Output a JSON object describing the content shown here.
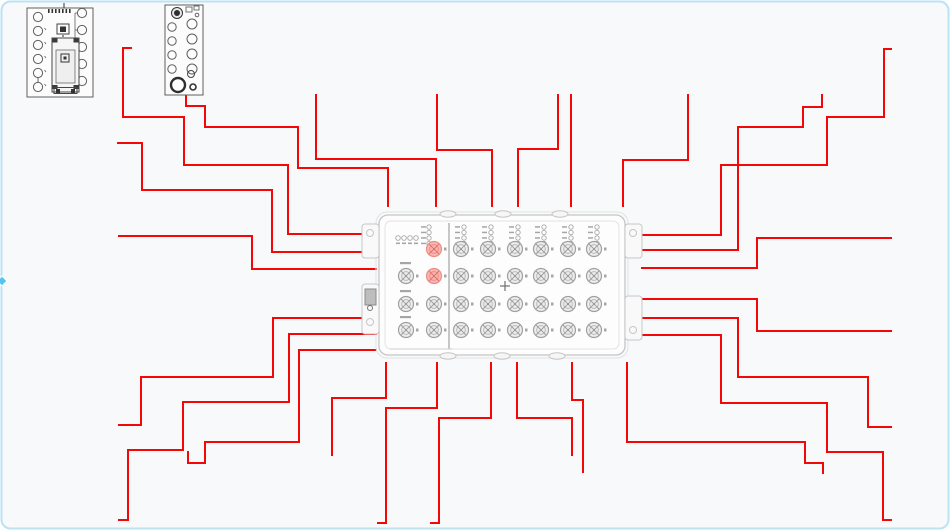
{
  "canvas": {
    "width": 950,
    "height": 530,
    "background": "#f8f9fa",
    "frame_color": "#bce2f4",
    "frame_radius": 9,
    "handle": {
      "x": 2,
      "y": 281,
      "size": 7
    }
  },
  "colors": {
    "wire": "#f50707",
    "handle": "#52c5f2",
    "device_outline": "#c6c6c6",
    "device_outline_light": "#e2e2e2",
    "device_fill": "#fdfdfd",
    "divider": "#b5b5b5",
    "port_stroke": "#a0a0a0",
    "port_fill": "#ededed",
    "port_inner": "#b8b8b8",
    "port_cross": "#9a9a9a",
    "pink_fill": "#f7b6b1",
    "pink_stroke": "#ef8d85",
    "pink_cross": "#e06e65",
    "led_stroke": "#a8a8a8",
    "speck": "#a6a6a6",
    "center_cross": "#6f6f6f",
    "module_stroke": "#5f5f5f",
    "module_dark": "#333333",
    "ear_dark": "#8a8a8a"
  },
  "wires": [
    {
      "id": "upper-left-1",
      "points": [
        [
          131,
          48
        ],
        [
          123,
          48
        ],
        [
          123,
          117
        ],
        [
          184,
          117
        ],
        [
          184,
          165
        ],
        [
          288,
          165
        ],
        [
          288,
          234
        ],
        [
          376,
          234
        ]
      ]
    },
    {
      "id": "upper-left-2",
      "points": [
        [
          118,
          143
        ],
        [
          142,
          143
        ],
        [
          142,
          190
        ],
        [
          272,
          190
        ],
        [
          272,
          252
        ],
        [
          376,
          252
        ]
      ]
    },
    {
      "id": "upper-left-3",
      "points": [
        [
          119,
          236
        ],
        [
          252,
          236
        ],
        [
          252,
          269
        ],
        [
          376,
          269
        ]
      ]
    },
    {
      "id": "lower-left-1",
      "points": [
        [
          376,
          318
        ],
        [
          273,
          318
        ],
        [
          273,
          377
        ],
        [
          141,
          377
        ],
        [
          141,
          425
        ],
        [
          119,
          425
        ]
      ]
    },
    {
      "id": "lower-left-2",
      "points": [
        [
          376,
          334
        ],
        [
          289,
          334
        ],
        [
          289,
          402
        ],
        [
          183,
          402
        ],
        [
          183,
          450
        ],
        [
          128,
          450
        ],
        [
          128,
          520
        ],
        [
          119,
          520
        ]
      ]
    },
    {
      "id": "lower-left-3",
      "points": [
        [
          376,
          350
        ],
        [
          299,
          350
        ],
        [
          299,
          442
        ],
        [
          205,
          442
        ],
        [
          205,
          463
        ],
        [
          188,
          463
        ],
        [
          188,
          452
        ]
      ]
    },
    {
      "id": "module2-feed",
      "points": [
        [
          186,
          93
        ],
        [
          186,
          106
        ],
        [
          205,
          106
        ],
        [
          205,
          127
        ],
        [
          298,
          127
        ],
        [
          298,
          168
        ],
        [
          388,
          168
        ],
        [
          388,
          206
        ]
      ]
    },
    {
      "id": "top-2",
      "points": [
        [
          316,
          95
        ],
        [
          316,
          159
        ],
        [
          436,
          159
        ],
        [
          436,
          206
        ]
      ]
    },
    {
      "id": "top-3",
      "points": [
        [
          437,
          95
        ],
        [
          437,
          150
        ],
        [
          492,
          150
        ],
        [
          492,
          206
        ]
      ]
    },
    {
      "id": "top-4",
      "points": [
        [
          558,
          95
        ],
        [
          558,
          149
        ],
        [
          518,
          149
        ],
        [
          518,
          206
        ]
      ]
    },
    {
      "id": "top-5",
      "points": [
        [
          571,
          95
        ],
        [
          571,
          206
        ]
      ]
    },
    {
      "id": "top-6",
      "points": [
        [
          688,
          95
        ],
        [
          688,
          160
        ],
        [
          623,
          160
        ],
        [
          623,
          206
        ]
      ]
    },
    {
      "id": "bottom-1",
      "points": [
        [
          386,
          363
        ],
        [
          386,
          398
        ],
        [
          332,
          398
        ],
        [
          332,
          455
        ]
      ]
    },
    {
      "id": "bottom-2",
      "points": [
        [
          437,
          363
        ],
        [
          437,
          408
        ],
        [
          386,
          408
        ],
        [
          386,
          523
        ],
        [
          378,
          523
        ]
      ]
    },
    {
      "id": "bottom-3",
      "points": [
        [
          491,
          363
        ],
        [
          491,
          418
        ],
        [
          439,
          418
        ],
        [
          439,
          523
        ],
        [
          431,
          523
        ]
      ]
    },
    {
      "id": "bottom-4",
      "points": [
        [
          517,
          363
        ],
        [
          517,
          418
        ],
        [
          572,
          418
        ],
        [
          572,
          455
        ]
      ]
    },
    {
      "id": "bottom-5",
      "points": [
        [
          572,
          363
        ],
        [
          572,
          400
        ],
        [
          583,
          400
        ],
        [
          583,
          472
        ]
      ]
    },
    {
      "id": "bottom-6",
      "points": [
        [
          627,
          363
        ],
        [
          627,
          442
        ],
        [
          805,
          442
        ],
        [
          805,
          463
        ],
        [
          823,
          463
        ],
        [
          823,
          473
        ]
      ]
    },
    {
      "id": "right-1",
      "points": [
        [
          642,
          235
        ],
        [
          721,
          235
        ],
        [
          721,
          165
        ],
        [
          827,
          165
        ],
        [
          827,
          117
        ],
        [
          884,
          117
        ],
        [
          884,
          49
        ],
        [
          891,
          49
        ]
      ]
    },
    {
      "id": "right-2",
      "points": [
        [
          642,
          250
        ],
        [
          738,
          250
        ],
        [
          738,
          127
        ],
        [
          803,
          127
        ],
        [
          803,
          107
        ],
        [
          822,
          107
        ],
        [
          822,
          95
        ]
      ]
    },
    {
      "id": "right-3",
      "points": [
        [
          642,
          268
        ],
        [
          757,
          268
        ],
        [
          757,
          238
        ],
        [
          891,
          238
        ]
      ]
    },
    {
      "id": "right-4",
      "points": [
        [
          642,
          299
        ],
        [
          757,
          299
        ],
        [
          757,
          331
        ],
        [
          891,
          331
        ]
      ]
    },
    {
      "id": "right-5",
      "points": [
        [
          642,
          318
        ],
        [
          738,
          318
        ],
        [
          738,
          377
        ],
        [
          868,
          377
        ],
        [
          868,
          427
        ],
        [
          891,
          427
        ]
      ]
    },
    {
      "id": "right-6",
      "points": [
        [
          642,
          335
        ],
        [
          721,
          335
        ],
        [
          721,
          403
        ],
        [
          827,
          403
        ],
        [
          827,
          452
        ],
        [
          883,
          452
        ],
        [
          883,
          520
        ],
        [
          891,
          520
        ]
      ]
    }
  ],
  "device": {
    "outer": {
      "x": 376,
      "y": 212,
      "w": 252,
      "h": 146,
      "r": 11
    },
    "body": {
      "x": 379,
      "y": 215,
      "w": 246,
      "h": 140,
      "r": 9
    },
    "inner": {
      "x": 385,
      "y": 221,
      "w": 234,
      "h": 128,
      "r": 6
    },
    "divider_x": 449,
    "divider_y1": 223,
    "divider_y2": 349,
    "top_tabs": [
      448,
      503,
      560
    ],
    "bottom_tabs": [
      448,
      502,
      557
    ],
    "left_ears": [
      {
        "x": 362,
        "y": 224,
        "w": 17,
        "h": 34
      },
      {
        "x": 362,
        "y": 284,
        "w": 17,
        "h": 50
      }
    ],
    "right_ears": [
      {
        "x": 625,
        "y": 224,
        "w": 17,
        "h": 34
      },
      {
        "x": 625,
        "y": 296,
        "w": 17,
        "h": 44
      }
    ],
    "ear_screws": [
      [
        370,
        233
      ],
      [
        370,
        322
      ],
      [
        633,
        233
      ],
      [
        633,
        330
      ]
    ],
    "dark_block": {
      "x": 365,
      "y": 289,
      "w": 11,
      "h": 16
    },
    "dark_block_screw": [
      370,
      308
    ],
    "port_r": 7.5,
    "grid_cols": [
      461,
      488,
      515,
      541,
      568,
      594
    ],
    "grid_rows": [
      249,
      276,
      304,
      330
    ],
    "col2_x": 434,
    "col2_rows": [
      249,
      276,
      304,
      330
    ],
    "col2_pink_rows": [
      0,
      1
    ],
    "left_col_x": 406,
    "left_col_rows": [
      276,
      304,
      330
    ],
    "led_stack_ys": [
      227,
      232.5,
      238,
      243.5
    ],
    "top_led_row": {
      "y": 238,
      "xs": [
        398,
        404,
        410,
        416
      ]
    },
    "top_led_stack_x": 429,
    "center_cross": {
      "x": 505,
      "y": 286,
      "arm": 5
    },
    "bottom_strip": {
      "x1": 390,
      "y": 349,
      "x2": 453
    }
  },
  "module1": {
    "frame": {
      "x": 27,
      "y": 8,
      "w": 66,
      "h": 89
    },
    "left_circles": {
      "cx": 38,
      "r": 4.6,
      "cys": [
        17,
        31,
        45,
        59,
        73,
        87
      ]
    },
    "right_circles": {
      "cx": 82,
      "r": 4.6,
      "cys": [
        13,
        30,
        47,
        64,
        81
      ]
    },
    "link_segment": [
      38,
      77.6,
      38,
      82.4
    ],
    "bracket": {
      "x": 75,
      "y1": 13,
      "y2": 47,
      "stub": 3
    },
    "header_smudge": {
      "x0": 48,
      "y": 9,
      "n": 7,
      "dx": 3.5
    },
    "top_glyph": [
      64,
      3,
      64,
      8
    ],
    "component": {
      "x": 57,
      "y": 24,
      "w": 12,
      "h": 10
    },
    "component_core": {
      "x": 60,
      "y": 26.5,
      "w": 6,
      "h": 5.5
    },
    "dots": [
      [
        63,
        36
      ],
      [
        63,
        39
      ],
      [
        63,
        42
      ]
    ],
    "body": {
      "x": 52,
      "y": 38,
      "w": 27,
      "h": 54
    },
    "body_inner": {
      "x": 56,
      "y": 50,
      "w": 19,
      "h": 33
    },
    "corner_tabs": [
      [
        52.5,
        38.5
      ],
      [
        73.5,
        38.5
      ],
      [
        52.5,
        85
      ],
      [
        73.5,
        85
      ]
    ],
    "center_square": {
      "x": 61,
      "y": 54,
      "w": 8,
      "h": 8
    },
    "bottom_plate": {
      "x": 54,
      "y": 87.5,
      "w": 23,
      "h": 6
    },
    "plate_screws": [
      [
        56,
        89
      ],
      [
        71,
        89
      ]
    ]
  },
  "module2": {
    "frame": {
      "x": 165,
      "y": 5,
      "w": 38,
      "h": 90
    },
    "top_circle": {
      "cx": 177,
      "cy": 13,
      "r": 5.5,
      "core_r": 3
    },
    "top_rects": [
      {
        "x": 186,
        "y": 7,
        "w": 6,
        "h": 5
      },
      {
        "x": 194,
        "y": 6,
        "w": 5,
        "h": 4
      }
    ],
    "top_small_circle": {
      "cx": 197,
      "cy": 15,
      "r": 1.8
    },
    "left_circles": {
      "cx": 172,
      "r": 4.2,
      "cys": [
        27,
        41,
        55,
        69
      ]
    },
    "right_circles": {
      "cx": 192,
      "r": 5.0,
      "cys": [
        24,
        39,
        54,
        69
      ]
    },
    "big_circle": {
      "cx": 178,
      "cy": 85,
      "r": 7
    },
    "small_circle_1": {
      "cx": 191,
      "cy": 74,
      "r": 3.5
    },
    "small_circle_2": {
      "cx": 193,
      "cy": 87,
      "r": 3
    }
  }
}
